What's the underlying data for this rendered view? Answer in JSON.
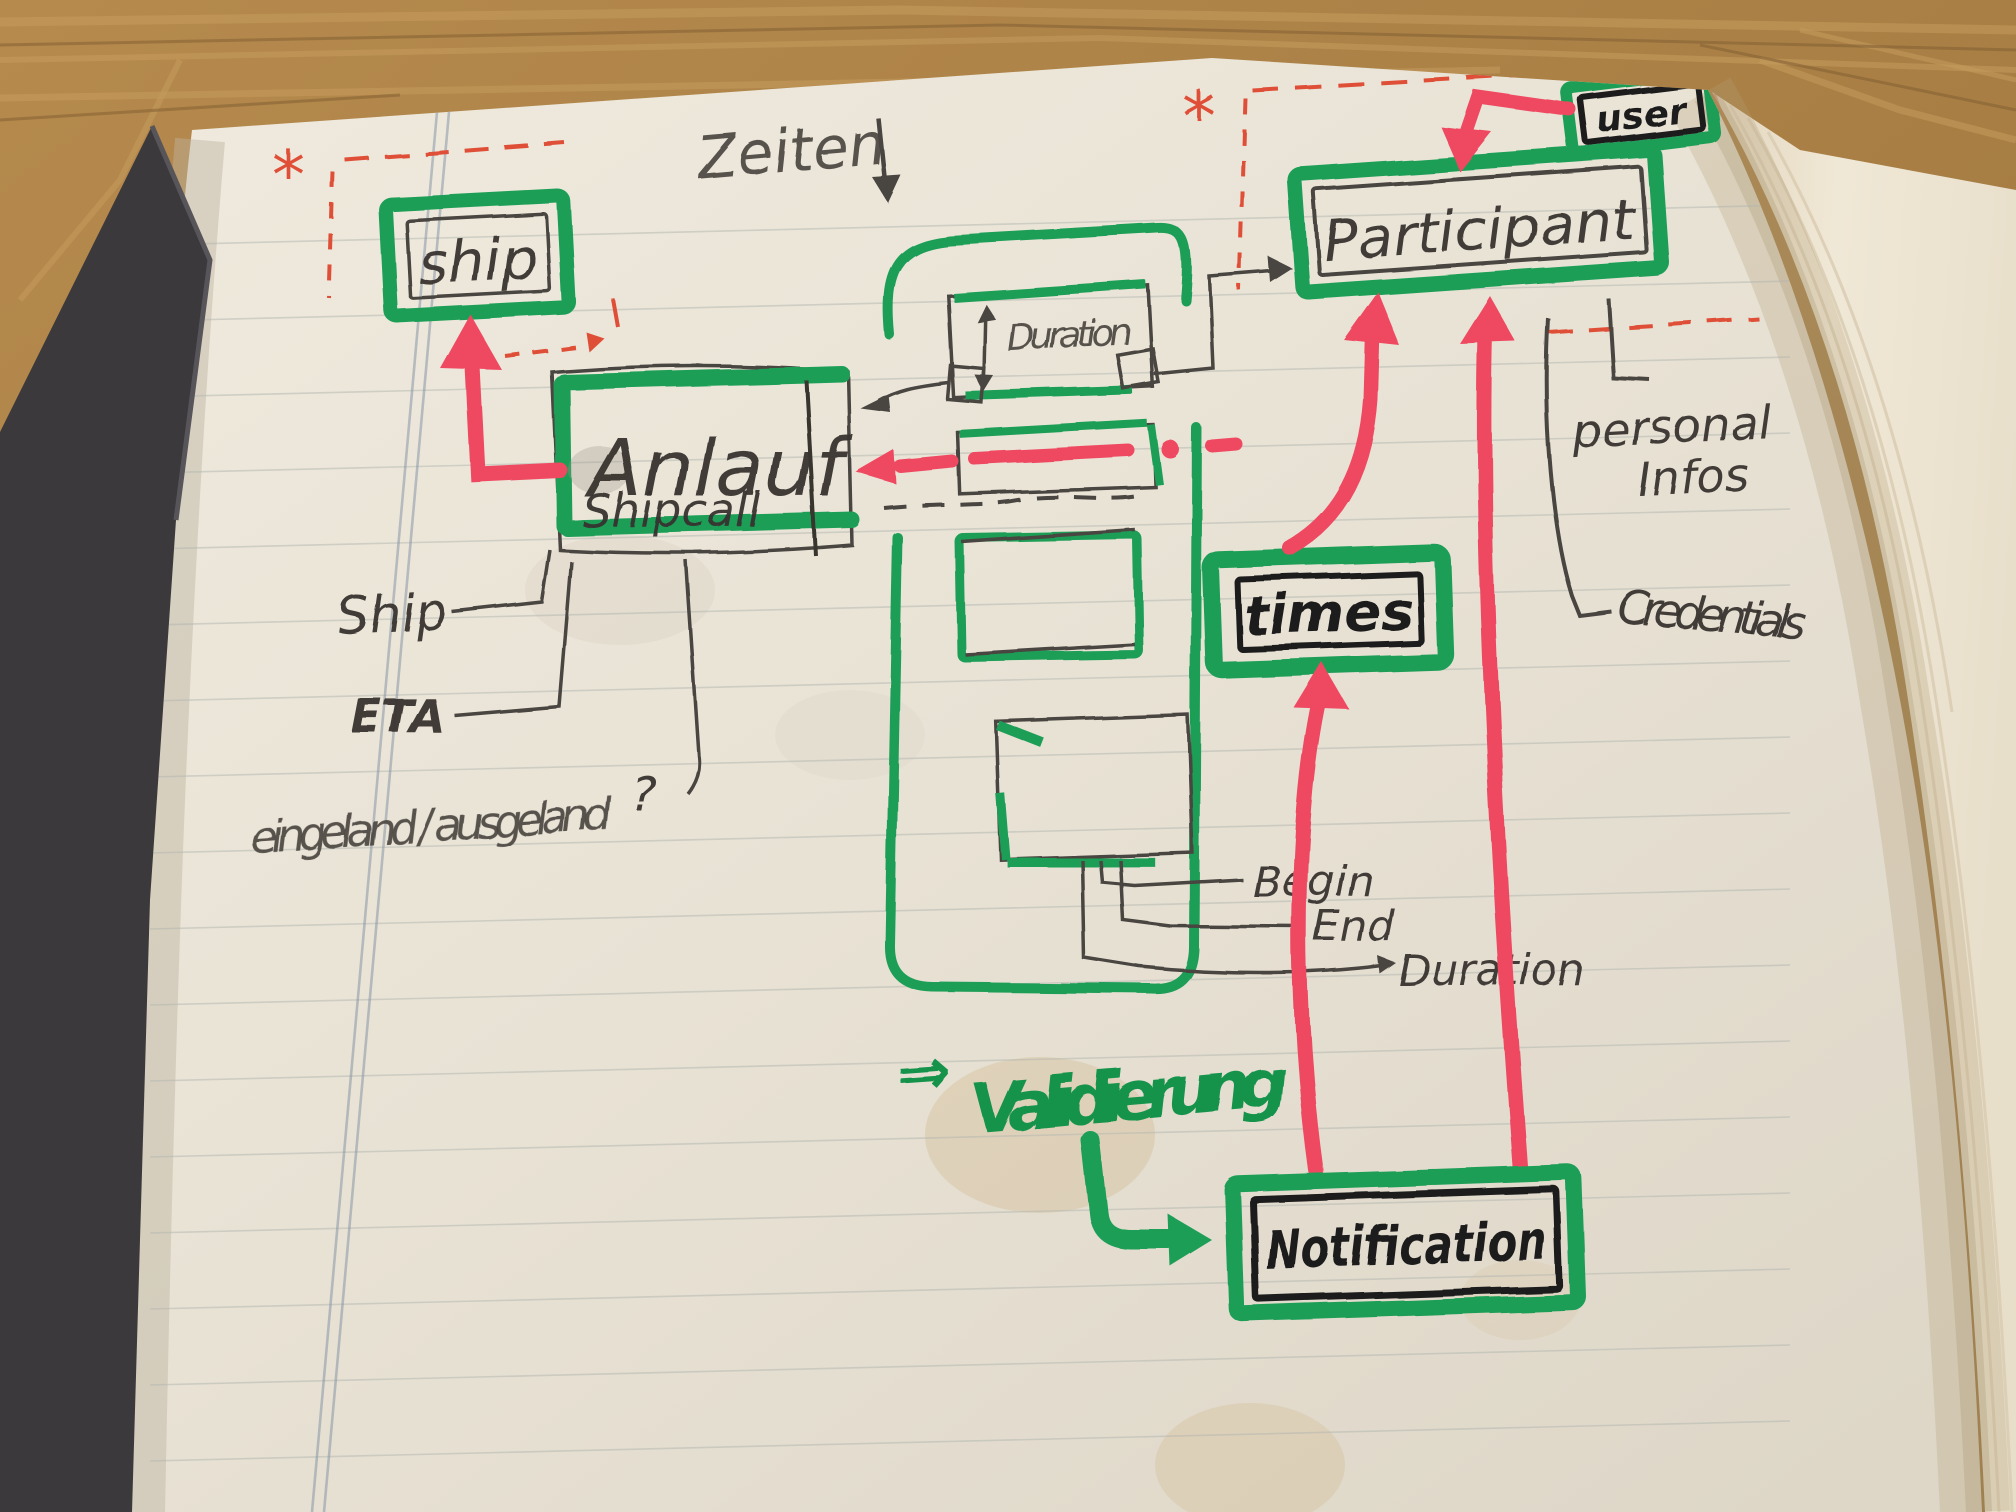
{
  "boxes": {
    "ship": "ship",
    "anlauf": "Anlauf",
    "anlauf_sub": "Shipcall",
    "duration": "Duration",
    "participant": "Participant",
    "user": "user",
    "times": "times",
    "notification": "Notification"
  },
  "annotations": {
    "zeiten": "Zeiten",
    "ship_attr": "Ship",
    "eta_attr": "ETA",
    "eingeland_attr": "eingeland / ausgeland",
    "question_mark": "?",
    "begin_attr": "Begin",
    "end_attr": "End",
    "duration_attr": "Duration",
    "personal_line1": "personal",
    "personal_line2": "Infos",
    "credentials_attr": "Credentials",
    "validierung_arrow": "⇒",
    "validierung": "Validierung",
    "asterisk": "*"
  },
  "colors": {
    "green_marker": "#1f9e57",
    "red_marker": "#ef4a62",
    "red_pen": "#df5038",
    "pencil": "#4a4440",
    "black_marker": "#1d1c1e",
    "paper": "#e9e3d6",
    "wood": "#a97f45",
    "cover": "#3b393c"
  }
}
